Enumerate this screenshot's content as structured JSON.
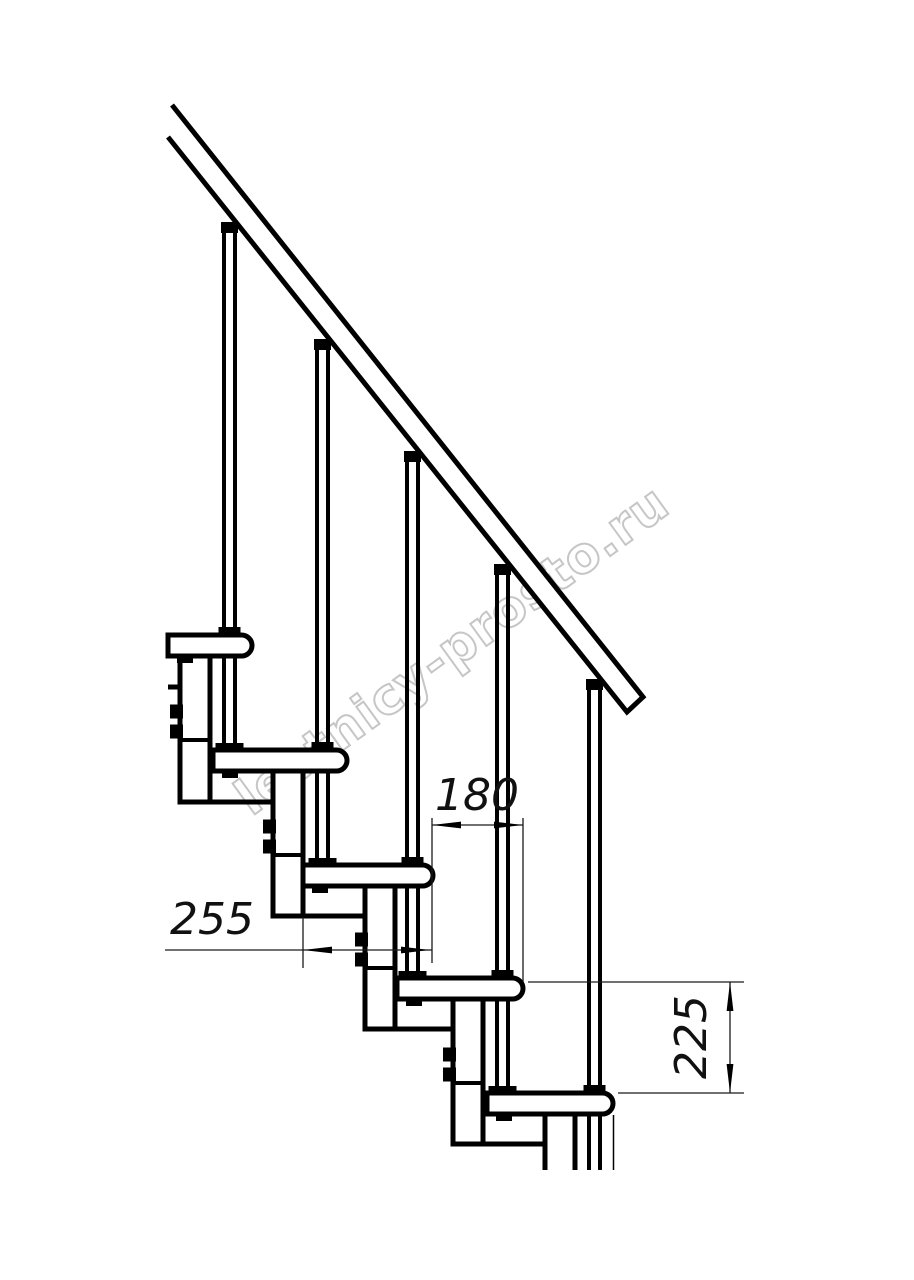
{
  "watermark": {
    "text": "lestnicy-prosto.ru",
    "color": "#c6c6c6"
  },
  "colors": {
    "background": "#ffffff",
    "line": "#000000",
    "dimension": "#1a1a1a"
  },
  "dimensions": {
    "tread_depth": {
      "value": "255",
      "orientation": "horizontal"
    },
    "step_run": {
      "value": "180",
      "orientation": "horizontal"
    },
    "step_rise": {
      "value": "225",
      "orientation": "vertical"
    }
  },
  "structure": {
    "treads": 5,
    "balusters": 5,
    "handrail": true
  }
}
